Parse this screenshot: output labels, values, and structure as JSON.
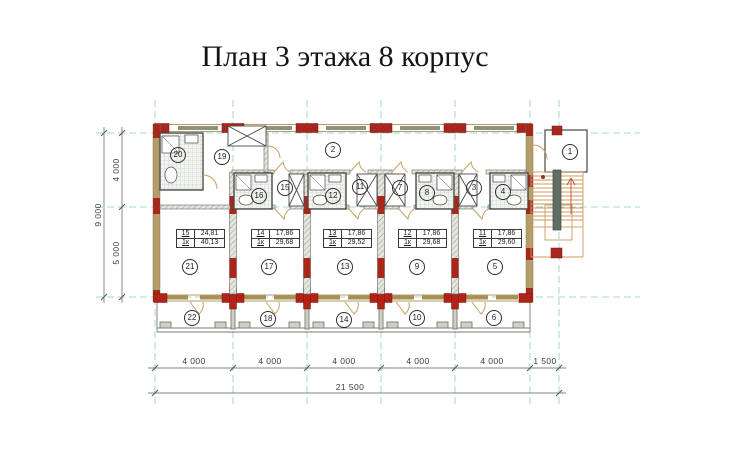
{
  "title": "План 3 этажа 8 корпус",
  "rooms": {
    "stair_landing": "1",
    "corridor": "2",
    "hall3": "3",
    "bath4": "4",
    "room5": "5",
    "balcony6": "6",
    "hall7": "7",
    "bath8": "8",
    "room9": "9",
    "balcony10": "10",
    "hall11": "11",
    "bath12": "12",
    "room13": "13",
    "balcony14": "14",
    "hall15": "15",
    "bath16": "16",
    "room17": "17",
    "balcony18": "18",
    "vestibule19": "19",
    "bath20": "20",
    "room21": "21",
    "balcony22": "22"
  },
  "area_tables": {
    "u21": {
      "num": "15",
      "area": "24,81",
      "type": "1к",
      "total": "40,13"
    },
    "u17": {
      "num": "14",
      "area": "17,86",
      "type": "1к",
      "total": "29,68"
    },
    "u13": {
      "num": "13",
      "area": "17,86",
      "type": "1к",
      "total": "29,52"
    },
    "u9": {
      "num": "12",
      "area": "17,86",
      "type": "1к",
      "total": "29,68"
    },
    "u5": {
      "num": "11",
      "area": "17,86",
      "type": "1к",
      "total": "29,60"
    }
  },
  "dimensions": {
    "bay1": "4 000",
    "bay2": "4 000",
    "bay3": "4 000",
    "bay4": "4 000",
    "bay5": "4 000",
    "bay6": "1 500",
    "total_width": "21 500",
    "left_top": "4 000",
    "left_bottom": "5 000",
    "left_total": "9 000"
  },
  "colors": {
    "grid_axis": "#8fcdbd",
    "brick_pier": "#a8271d",
    "wall_tan": "#b39e6b",
    "lintel_gray": "#8f8f85",
    "stair_orange": "#cf9a62",
    "stringer_green": "#5f6e65"
  }
}
